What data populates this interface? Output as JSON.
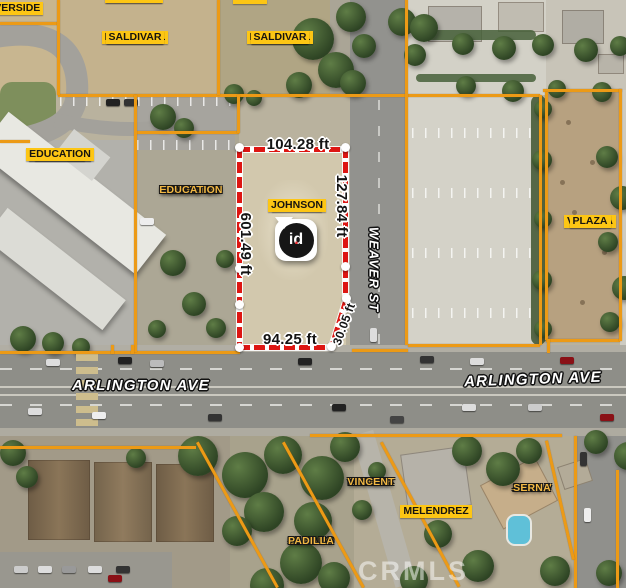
{
  "watermark": "CRMLS",
  "streets": {
    "arlington_left": "ARLINGTON AVE",
    "arlington_right": "ARLINGTON AVE",
    "weaver": "WEAVER ST"
  },
  "pin": {
    "brand": "id",
    "dot": "."
  },
  "dimensions": {
    "top": "104.28 ft",
    "left": "601.49 ft",
    "right": "127.84 ft",
    "bottom": "94.25 ft",
    "diagonal": "30.05 ft"
  },
  "parcel_labels": {
    "riverside_corner": {
      "lines": [
        "RIVERSIDE"
      ]
    },
    "palafox_top": {
      "lines": [
        "PALAFOX",
        "SALDIVAR"
      ]
    },
    "sunt_top": {
      "lines": [
        "SUNT"
      ]
    },
    "emmanuel_west": {
      "lines": [
        "EMMANUEL",
        "PALAFOX",
        "SALDIVAR"
      ]
    },
    "emmanuel_east": {
      "lines": [
        "EMMANUEL",
        "PALAFOX",
        "SALDIVAR"
      ]
    },
    "rcboe_west": {
      "lines": [
        "RIVERSIDE",
        "COUNTY",
        "BOARD OF",
        "EDUCATION"
      ]
    },
    "rcboe_east": {
      "lines": [
        "RIVERSIDE",
        "COUNTY",
        "BOARD OF",
        "EDUCATION"
      ]
    },
    "eugene_johnson": {
      "lines": [
        "EUGENE",
        "JOHNSON"
      ]
    },
    "valinda_plaza": {
      "lines": [
        "VALINDA",
        "PLAZA"
      ]
    },
    "daniel_patrick_vincent": {
      "lines": [
        "DANIEL",
        "PATRICK",
        "VINCENT"
      ]
    },
    "melendrez": {
      "lines": [
        "MELENDREZ"
      ]
    },
    "juan_v_serna": {
      "lines": [
        "JUAN V",
        "SERNA"
      ]
    },
    "silvano_padilla": {
      "lines": [
        "SILVANO",
        "PADILLA"
      ]
    }
  },
  "colors": {
    "parcel_line_orange": "#EC9A16",
    "dimension_red": "#DD1612",
    "label_yellow": "#FDC614",
    "label_gold": "#F2B844",
    "pin_dot_red": "#E8252A"
  }
}
